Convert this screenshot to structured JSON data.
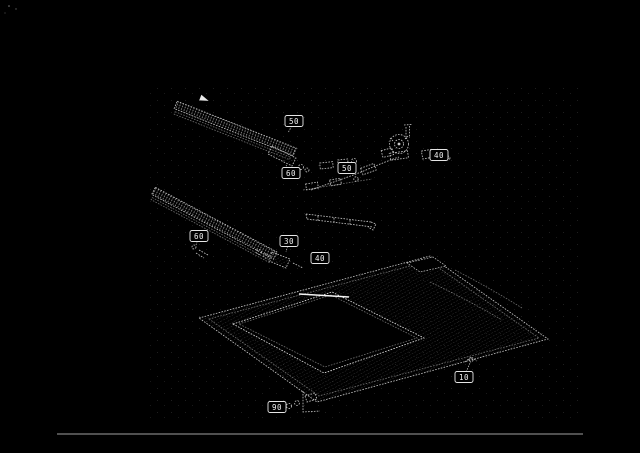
{
  "page": {
    "background_color": "#000000",
    "ink_color": "#c9c9c9",
    "highlight_color": "#ffffff",
    "rule_color": "#a0a0a0"
  },
  "figure": {
    "kind": "exploded-parts-diagram",
    "visible_text_only_items": "numeric part callouts"
  },
  "callouts": [
    {
      "label": "50",
      "x": 294,
      "y": 121,
      "leader": [
        288,
        133
      ]
    },
    {
      "label": "60",
      "x": 291,
      "y": 173,
      "leader": [
        286,
        165
      ]
    },
    {
      "label": "50",
      "x": 347,
      "y": 168,
      "leader": [
        356,
        174
      ]
    },
    {
      "label": "40",
      "x": 439,
      "y": 155,
      "leader": [
        431,
        158
      ]
    },
    {
      "label": "60",
      "x": 199,
      "y": 236,
      "leader": [
        196,
        245
      ]
    },
    {
      "label": "30",
      "x": 289,
      "y": 241,
      "leader": [
        286,
        252
      ]
    },
    {
      "label": "40",
      "x": 320,
      "y": 258,
      "leader": [
        313,
        263
      ]
    },
    {
      "label": "10",
      "x": 464,
      "y": 377,
      "leader": [
        470,
        363
      ]
    },
    {
      "label": "90",
      "x": 277,
      "y": 407,
      "leader": [
        286,
        405
      ]
    }
  ],
  "bottom_rule": {
    "x1": 57,
    "y1": 434,
    "x2": 583,
    "y2": 434
  }
}
